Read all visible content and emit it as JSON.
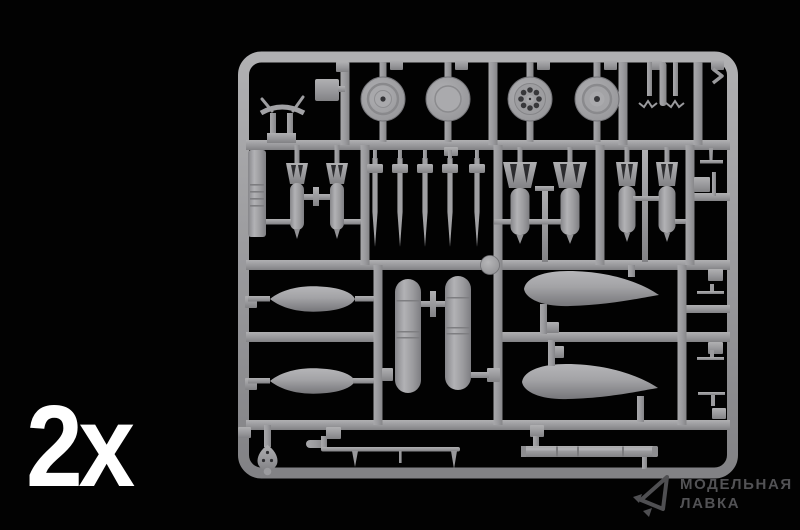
{
  "overlay": {
    "quantity_label": "2x"
  },
  "watermark": {
    "line1": "МОДЕЛЬНАЯ",
    "line2": "ЛАВКА",
    "icon": "paper-plane-logo"
  },
  "photo": {
    "description": "Grey injection-molded plastic sprue (model kit parts frame) photographed on a black background",
    "visible_parts": [
      {
        "part": "wheel",
        "count": 4
      },
      {
        "part": "small-bomb",
        "count": 2
      },
      {
        "part": "rocket-dart",
        "count": 5
      },
      {
        "part": "large-bomb",
        "count": 4
      },
      {
        "part": "small-drop-tank",
        "count": 2
      },
      {
        "part": "fuel-pod",
        "count": 2
      },
      {
        "part": "large-drop-tank",
        "count": 2
      },
      {
        "part": "barrel-rod",
        "count": 2
      }
    ]
  },
  "colors": {
    "background": "#000000",
    "sprue_base": "#98989b",
    "sprue_highlight": "#b2b2b5",
    "sprue_shadow": "#7a7a7e",
    "dark_holes": "#2e2e31",
    "watermark": "#525255",
    "quantity_label": "#ffffff"
  }
}
